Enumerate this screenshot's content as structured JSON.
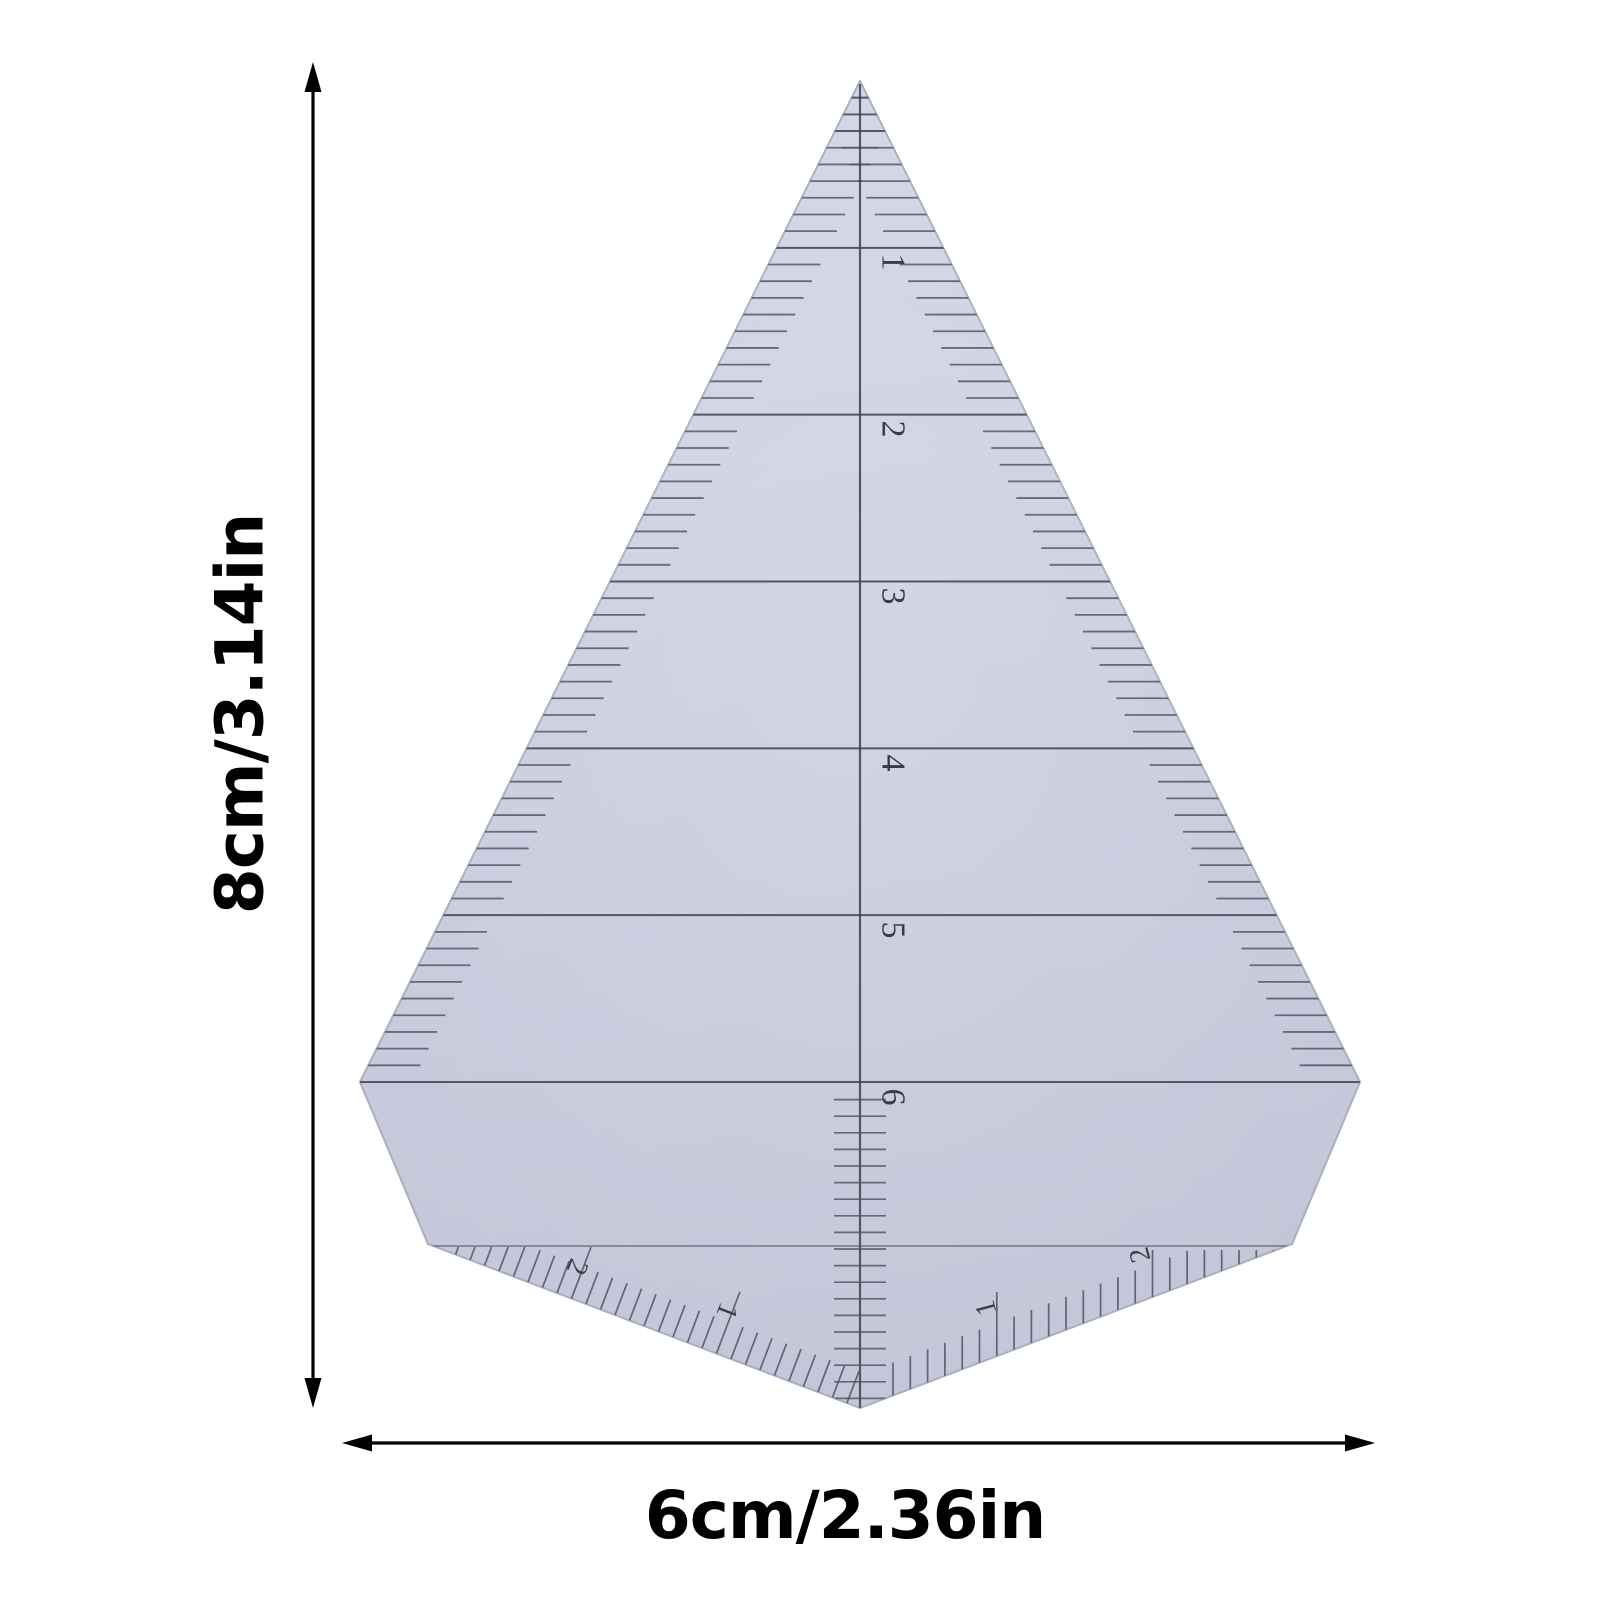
{
  "annotations": {
    "height_label": "8cm/3.14in",
    "width_label": "6cm/2.36in"
  },
  "ruler": {
    "center_scale_numbers": [
      "1",
      "2",
      "3",
      "4",
      "5",
      "6"
    ],
    "bottom_left_scale_numbers": [
      "1",
      "2"
    ],
    "bottom_right_scale_numbers": [
      "1",
      "2"
    ],
    "colors": {
      "body_top": "#d1d5e6",
      "body_mid": "#c8ccde",
      "body_bottom": "#c2c6d8",
      "edge": "#a9adc2",
      "line": "#41414c",
      "tick": "#53535f",
      "arrow": "#000000"
    }
  }
}
